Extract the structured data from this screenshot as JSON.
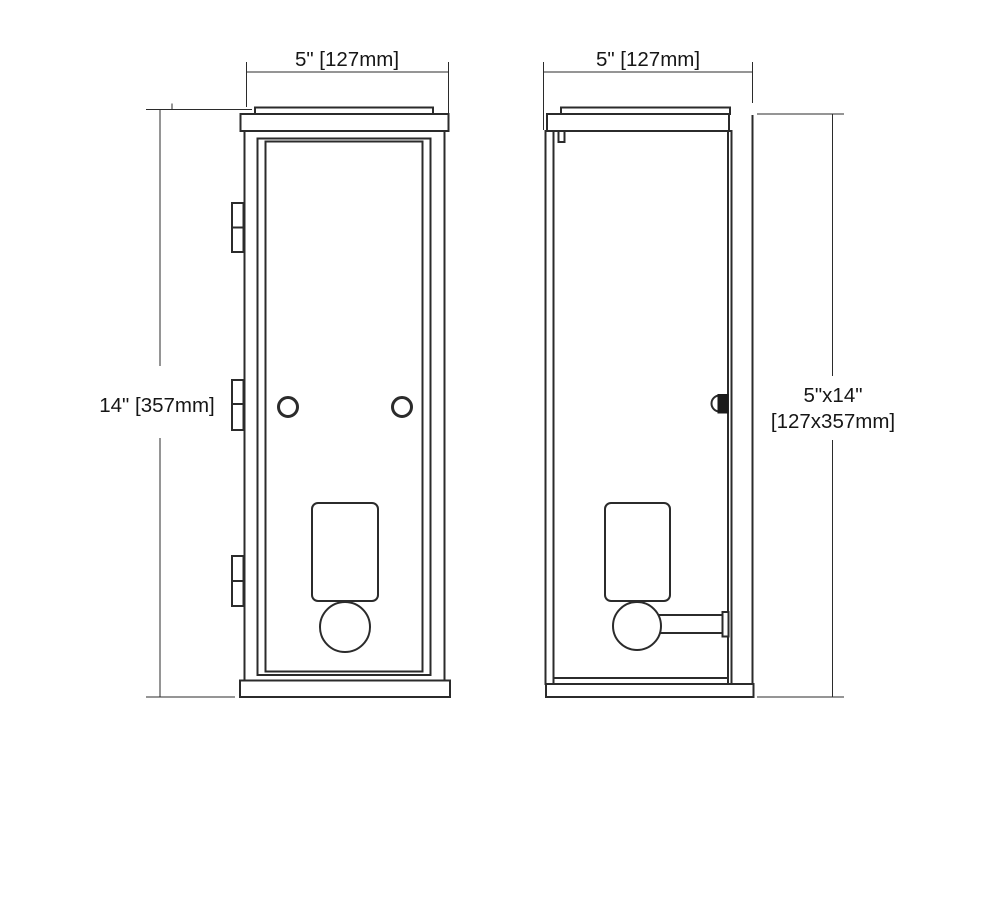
{
  "page": {
    "background": "#ffffff",
    "line_color": "#2b2b2b",
    "description": "Two-view dimension drawing of a rectangular wall sconce lantern"
  },
  "labels": {
    "front_width": "5\" [127mm]",
    "side_depth": "5\" [127mm]",
    "height": "14\" [357mm]",
    "overall_size_line1": "5\"x14\"",
    "overall_size_line2": "[127x357mm]"
  }
}
